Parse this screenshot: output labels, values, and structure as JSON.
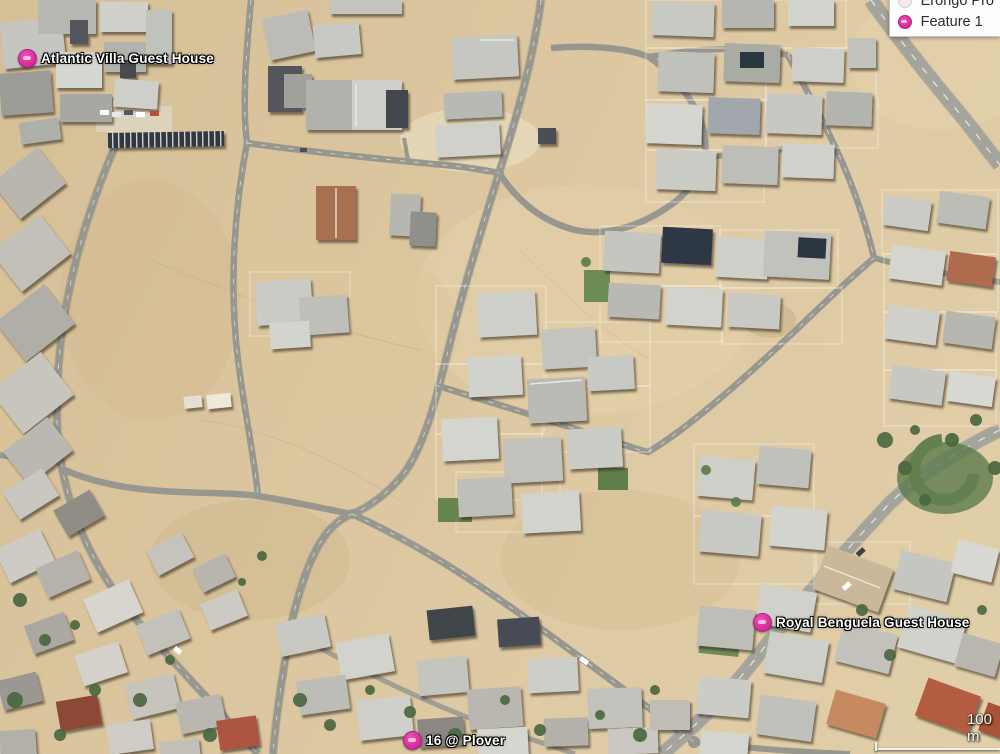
{
  "view": {
    "type": "satellite-imagery",
    "description": "Aerial view of a desert residential suburb with sand lots, curving streets and scattered houses"
  },
  "placemarks": [
    {
      "label": "Atlantic Villa Guest House",
      "icon": "placemark-pin-icon"
    },
    {
      "label": "Royal Benguela Guest House",
      "icon": "placemark-pin-icon"
    },
    {
      "label": "16 @ Plover",
      "icon": "placemark-pin-icon"
    }
  ],
  "legend": {
    "items": [
      {
        "label": "Erongo Pro",
        "icon": "layer-swatch-icon"
      },
      {
        "label": "Feature 1",
        "icon": "placemark-dot-icon"
      }
    ]
  },
  "scale_bar": {
    "label": "100 m"
  },
  "colors": {
    "placemark_pink": "#d0309a",
    "sand": "#d9c39a",
    "road_gray": "#97978f",
    "wide_road_gray": "#a4a49c",
    "vegetation_green": "#4a6840"
  }
}
